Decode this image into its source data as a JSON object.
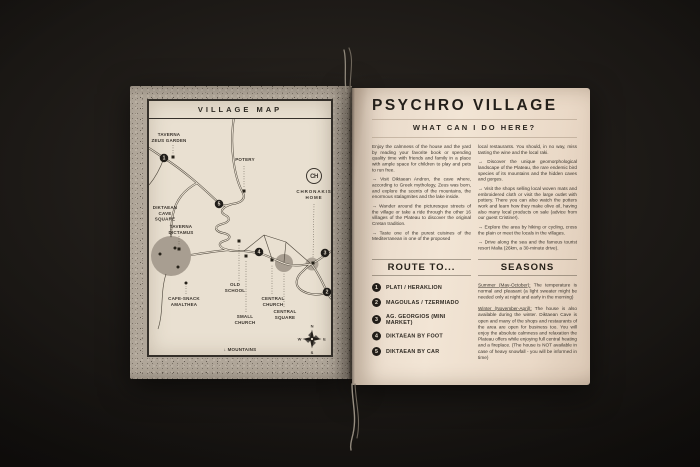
{
  "colors": {
    "background": "#17130f",
    "left_page_paper": "#b0a699",
    "map_paper": "#e9e0d1",
    "right_page_paper": "#f0e3d4",
    "ink": "#2b2620"
  },
  "left_page": {
    "title": "VILLAGE MAP",
    "labels": {
      "taverna_zeus": "TAVERNA\nZEUS GARDEN",
      "potery": "POTERY",
      "chronakis_monogram": "CH",
      "chronakis": "CHRONAKIS\nHOME",
      "diktaean_cave": "DIKTAEAN\nCAVE\nSQUARE",
      "taverna_dictamus": "TAVERNA\nDICTAMUS",
      "cafe_snack": "CAFE-SNACK\nAMALTHEA",
      "old_school": "OLD\nSCHOOL",
      "small_church": "SMALL\nCHURCH",
      "central_church": "CENTRAL\nCHURCH",
      "central_square": "CENTRAL\nSQUARE",
      "mountains": "↓ MOUNTAINS"
    },
    "markers": [
      "1",
      "2",
      "3",
      "4",
      "5"
    ],
    "compass": {
      "n": "N",
      "e": "E",
      "s": "S",
      "w": "W"
    }
  },
  "right_page": {
    "title": "PSYCHRO VILLAGE",
    "subtitle": "WHAT CAN I DO HERE?",
    "bullets_left": [
      "Enjoy the calmness of the house and the yard by reading your favorite book or spending quality time with friends and family in a place with ample space for children to play and pets to run free.",
      "→ Visit Diktaean Andron, the cave where, according to Greek mythology, Zeus was born, and explore the scents of the mountains, the enormous stalagmites and the lake inside.",
      "→ Wander around the picturesque streets of the village or take a ride through the other 16 villages of the Plateau to discover the original Cretan tradition.",
      "→ Taste one of the purest cuisines of the Mediterranean in one of the proposed"
    ],
    "bullets_right": [
      "local restaurants. You should, in no way, miss tasting the wine and the local raki.",
      "→ Discover the unique geomorphological landscape of the Plateau, the rare endemic bird species of its mountains and the hidden caves and gorges.",
      "→ Visit the shops selling local woven mats and embroidered cloth or visit the large outlet with pottery. There you can also watch the potters work and learn how they make olive oil, having also many local products on sale (advice from our guest Cristine!).",
      "→ Explore the area by hiking or cycling, cross the plain or meet the locals in the villages.",
      "→ Drive along the sea and the famous tourist resort Malia (26km, a 30-minute drive)."
    ],
    "route": {
      "title": "ROUTE TO...",
      "items": [
        {
          "num": "1",
          "label": "PLATI / HERAKLION"
        },
        {
          "num": "2",
          "label": "MAGOULAS / TZERMIADO"
        },
        {
          "num": "3",
          "label": "AG. GEORGIOS (MINI MARKET)"
        },
        {
          "num": "4",
          "label": "DIKTAEAN BY FOOT"
        },
        {
          "num": "5",
          "label": "DIKTAEAN BY CAR"
        }
      ]
    },
    "seasons": {
      "title": "SEASONS",
      "paragraphs": [
        {
          "lead": "Summer (May-October):",
          "rest": " The temperature is normal and pleasant (a light sweater might be needed only at night and early in the morning)"
        },
        {
          "lead": "Winter (November-April):",
          "rest": " The house is also available during the winter. Diktaean Cave is open and many of the shops and restaurants of the area are open for business too. You will enjoy the absolute calmness and relaxation the Plateau offers while enjoying full central heating and a fireplace. (The house is NOT available in case of heavy snowfall - you will be informed in time)"
        }
      ]
    }
  }
}
